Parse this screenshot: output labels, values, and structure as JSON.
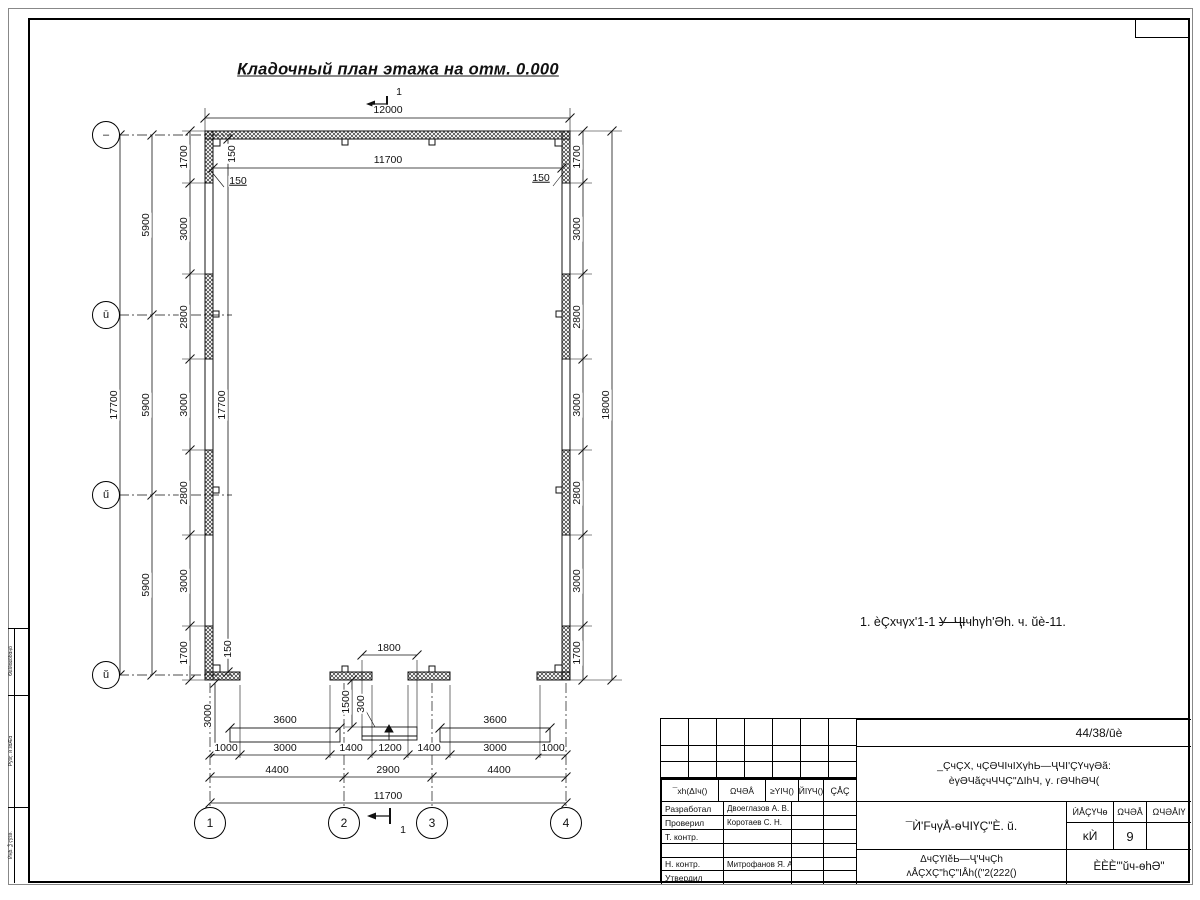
{
  "title": "Кладочный план этажа на отм. 0.000",
  "note": {
    "pre": "1. èÇхчγх'1-1 ",
    "strike": "У–ҶI",
    "post": "чhγh'Әh. ч. ŭè-11."
  },
  "axes": {
    "rows": [
      {
        "label": "–",
        "x": 106,
        "y": 135
      },
      {
        "label": "ū",
        "x": 106,
        "y": 315
      },
      {
        "label": "ű",
        "x": 106,
        "y": 495
      },
      {
        "label": "ŭ",
        "x": 106,
        "y": 675
      }
    ],
    "cols": [
      {
        "label": "1",
        "x": 210,
        "y": 823
      },
      {
        "label": "2",
        "x": 344,
        "y": 823
      },
      {
        "label": "3",
        "x": 432,
        "y": 823
      },
      {
        "label": "4",
        "x": 566,
        "y": 823
      }
    ]
  },
  "dim_labels": [
    {
      "t": "12000",
      "x": 388,
      "y": 110
    },
    {
      "t": "11700",
      "x": 388,
      "y": 160
    },
    {
      "t": "150",
      "x": 232,
      "y": 154,
      "r": 1
    },
    {
      "t": "150",
      "x": 238,
      "y": 181,
      "u": 1
    },
    {
      "t": "150",
      "x": 541,
      "y": 178,
      "u": 1
    },
    {
      "t": "1700",
      "x": 184,
      "y": 157,
      "r": 1
    },
    {
      "t": "3000",
      "x": 184,
      "y": 229,
      "r": 1
    },
    {
      "t": "2800",
      "x": 184,
      "y": 317,
      "r": 1
    },
    {
      "t": "3000",
      "x": 184,
      "y": 405,
      "r": 1
    },
    {
      "t": "2800",
      "x": 184,
      "y": 493,
      "r": 1
    },
    {
      "t": "3000",
      "x": 184,
      "y": 581,
      "r": 1
    },
    {
      "t": "1700",
      "x": 184,
      "y": 653,
      "r": 1
    },
    {
      "t": "5900",
      "x": 146,
      "y": 225,
      "r": 1
    },
    {
      "t": "5900",
      "x": 146,
      "y": 405,
      "r": 1
    },
    {
      "t": "5900",
      "x": 146,
      "y": 585,
      "r": 1
    },
    {
      "t": "17700",
      "x": 114,
      "y": 405,
      "r": 1
    },
    {
      "t": "17700",
      "x": 222,
      "y": 405,
      "r": 1
    },
    {
      "t": "1700",
      "x": 577,
      "y": 157,
      "r": 1
    },
    {
      "t": "3000",
      "x": 577,
      "y": 229,
      "r": 1
    },
    {
      "t": "2800",
      "x": 577,
      "y": 317,
      "r": 1
    },
    {
      "t": "3000",
      "x": 577,
      "y": 405,
      "r": 1
    },
    {
      "t": "2800",
      "x": 577,
      "y": 493,
      "r": 1
    },
    {
      "t": "3000",
      "x": 577,
      "y": 581,
      "r": 1
    },
    {
      "t": "1700",
      "x": 577,
      "y": 653,
      "r": 1
    },
    {
      "t": "18000",
      "x": 606,
      "y": 405,
      "r": 1
    },
    {
      "t": "150",
      "x": 228,
      "y": 649,
      "r": 1
    },
    {
      "t": "3000",
      "x": 208,
      "y": 716,
      "r": 1
    },
    {
      "t": "1500",
      "x": 346,
      "y": 702,
      "r": 1
    },
    {
      "t": "300",
      "x": 361,
      "y": 704,
      "r": 1
    },
    {
      "t": "1800",
      "x": 389,
      "y": 648
    },
    {
      "t": "3600",
      "x": 285,
      "y": 720
    },
    {
      "t": "3600",
      "x": 495,
      "y": 720
    },
    {
      "t": "1000",
      "x": 226,
      "y": 748
    },
    {
      "t": "3000",
      "x": 285,
      "y": 748
    },
    {
      "t": "1400",
      "x": 351,
      "y": 748
    },
    {
      "t": "1200",
      "x": 390,
      "y": 748
    },
    {
      "t": "1400",
      "x": 429,
      "y": 748
    },
    {
      "t": "3000",
      "x": 495,
      "y": 748
    },
    {
      "t": "1000",
      "x": 553,
      "y": 748
    },
    {
      "t": "4400",
      "x": 277,
      "y": 770
    },
    {
      "t": "2900",
      "x": 388,
      "y": 770
    },
    {
      "t": "4400",
      "x": 499,
      "y": 770
    },
    {
      "t": "11700",
      "x": 388,
      "y": 796
    },
    {
      "t": "1",
      "x": 399,
      "y": 92
    },
    {
      "t": "1",
      "x": 403,
      "y": 830
    }
  ],
  "title_block": {
    "doc_number": "44/38/ūè",
    "project_line1": "_ÇчÇХ, чÇӘЧIчIХγhЬ—ҶЧI'ÇҮчγӘã:",
    "project_line2": "èγӘЧãçчЧЧÇ\"ΔIhЧ, γ. гӘЧhӘЧ(",
    "rev_headers": [
      "¯хh(ΔIч()",
      "ΩЧӘÅ",
      "≥YIЧ()",
      "ЙIҮЧ()",
      "ÇÅÇ"
    ],
    "roles": [
      {
        "role": "Разработал",
        "name": "Двоеглазов А. В."
      },
      {
        "role": "Проверил",
        "name": "Коротаев С. Н."
      },
      {
        "role": "Т. контр.",
        "name": ""
      },
      {
        "role": "",
        "name": ""
      },
      {
        "role": "Н. контр.",
        "name": "Митрофанов Я. А."
      },
      {
        "role": "Утвердил",
        "name": ""
      }
    ],
    "drawing_title": "¯Ѝ'FчγÅ-ѳЧIҮÇ\"È. ŭ.",
    "org_line1": "ΔчÇҮIĕЬ—Ҷ'ЧчÇh",
    "org_line2": "ʌÅÇХÇ\"hÇ\"IÅh((\"2(222()",
    "stage_headers": [
      "ЍÅÇҮЧѳ",
      "ΩЧӘÅ",
      "ΩЧӘÅIҮ"
    ],
    "stage": "ĸЍ",
    "sheet_num": "9",
    "sheets_total": "",
    "company": "ÈÈÈ'\"ŭч-ѳhӘ\""
  },
  "side_strip": [
    "ѲɕӀӣɑɕӧɓɑӊӧ",
    "Ҏӯӟҁ. ѝ ӟɑӔɑ",
    "Ѝӊɓ. Ѯ ҁӯӟӛ."
  ]
}
